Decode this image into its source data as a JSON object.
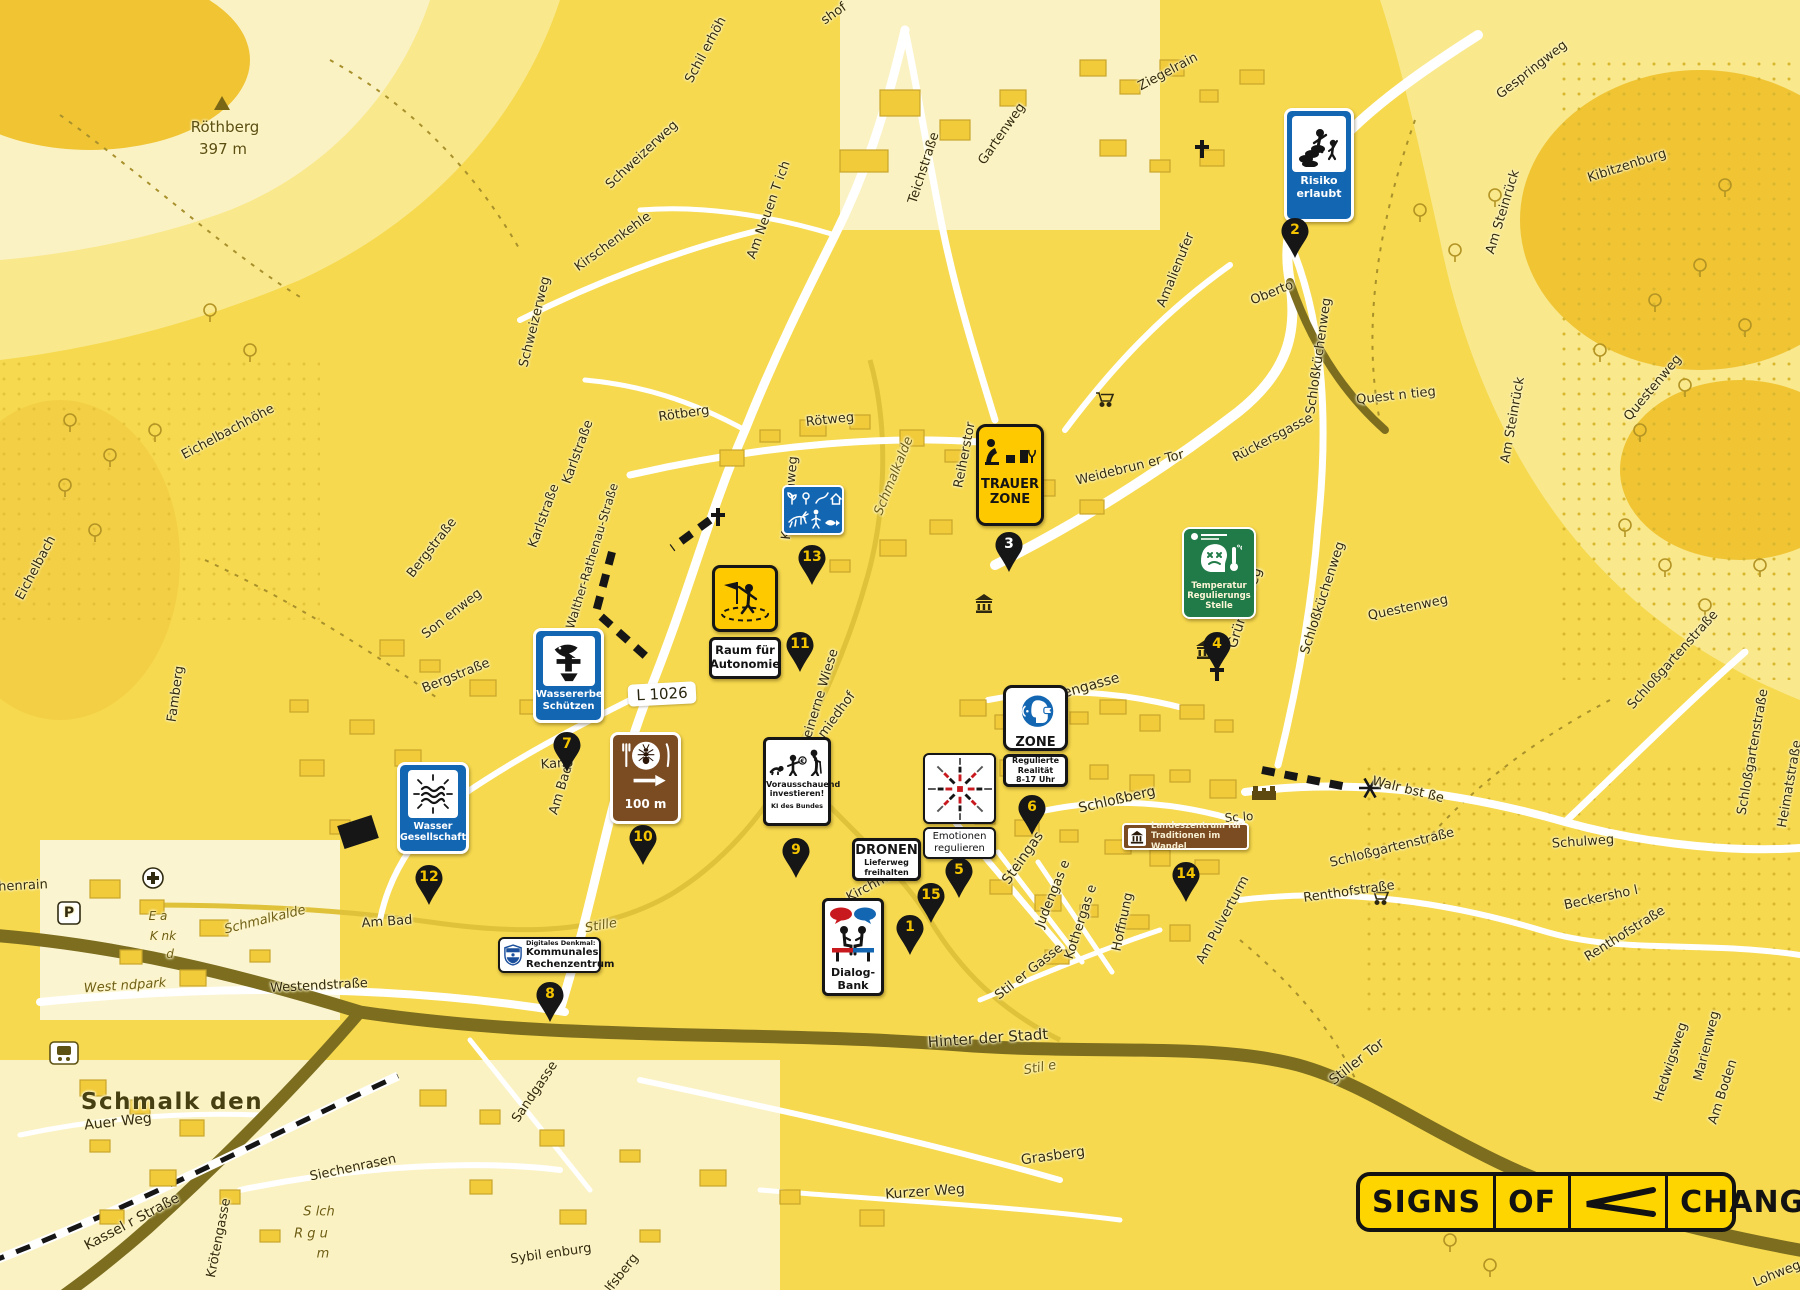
{
  "town": {
    "name": "Schmalk den"
  },
  "peak": {
    "name": "Röthberg",
    "elevation": "397 m"
  },
  "road_badge": "L 1026",
  "parking_label": "P",
  "logo": {
    "word1": "SIGNS",
    "word2": "OF",
    "word3": "CHANGE",
    "arrow_icon": "left-chevron-arrow",
    "bg_color": "#FFD500",
    "fg_color": "#121212"
  },
  "colors": {
    "map_base": "#F6D94E",
    "map_pale": "#FBF2C4",
    "road_white": "#FFFFFF",
    "road_major": "#7C6D1F",
    "sign_blue": "#1366B2",
    "sign_green": "#207B48",
    "sign_brown": "#7B4B22",
    "sign_yellow": "#FFC900",
    "pin_black": "#161616",
    "pin_number_yellow": "#F5C400",
    "accent_red": "#C8191E"
  },
  "icons": {
    "church": "cross-icon",
    "museum": "classical-building-icon",
    "peak": "triangle-icon",
    "hospital": "circle-plus-icon",
    "station": "train-icon",
    "cart": "shopping-cart-icon",
    "windmill": "asterisk-star-icon",
    "castle": "castle-icon"
  },
  "signs": {
    "risiko": {
      "line1": "Risiko",
      "line2": "erlaubt",
      "icon": "children-playing-on-rubble-icon"
    },
    "trauer": {
      "line1": "TRAUER",
      "line2": "ZONE",
      "icon": "mourning-person-tree-stumps-icon"
    },
    "temperatur": {
      "line1": "Temperatur",
      "line2": "Regulierungs",
      "line3": "Stelle",
      "unit": "C",
      "icon": "angry-head-thermometer-icon"
    },
    "wildlife": {
      "icon": "nature-pictogram-grid-icon"
    },
    "wassererbe": {
      "line1": "Wassererbe",
      "line2": "Schützen",
      "icon": "fish-totem-icon"
    },
    "raum": {
      "line1": "Raum für",
      "line2": "Autonomie",
      "icon": "figure-with-flag-icon"
    },
    "gasthaus": {
      "distance": "100 m",
      "icon": "insect-on-plate-fork-knife-icon",
      "arrow": "right-arrow-icon"
    },
    "vorausschauend": {
      "line1": "Vorausschauend",
      "line2": "investieren!",
      "sub": "KI des Bundes",
      "coin": "€",
      "icon": "baby-child-elder-icon"
    },
    "emotionen": {
      "line1": "Emotionen",
      "line2": "regulieren",
      "icon": "radial-emotion-diagram-icon"
    },
    "zone": {
      "title": "ZONE",
      "sub1": "Regulierte",
      "sub2": "Realität",
      "sub3": "8-17 Uhr",
      "icon": "vr-head-signal-icon"
    },
    "dronen": {
      "title": "DRONEN",
      "sub1": "Lieferweg",
      "sub2": "freihalten"
    },
    "dialog": {
      "line1": "Dialog-",
      "line2": "Bank",
      "icon": "two-figures-bench-speech-bubbles-icon"
    },
    "wasser": {
      "line1": "Wasser",
      "line2": "Gesellschaft",
      "icon": "radiant-waves-icon"
    },
    "rechenzentrum": {
      "kicker": "Digitales Denkmal:",
      "line1": "Kommunales",
      "line2": "Rechenzentrum",
      "icon": "heritage-shield-icon"
    },
    "landeszentrum": {
      "line1": "Landeszentrum für",
      "line2": "Traditionen im Wandel",
      "icon": "temple-icon"
    }
  },
  "markers": [
    {
      "n": "1",
      "color": "#F5C400"
    },
    {
      "n": "2",
      "color": "#F5C400"
    },
    {
      "n": "3",
      "color": "#FFFFFF"
    },
    {
      "n": "4",
      "color": "#F5C400"
    },
    {
      "n": "5",
      "color": "#F5C400"
    },
    {
      "n": "6",
      "color": "#F5C400"
    },
    {
      "n": "7",
      "color": "#F5C400"
    },
    {
      "n": "8",
      "color": "#F5C400"
    },
    {
      "n": "9",
      "color": "#F5C400"
    },
    {
      "n": "10",
      "color": "#F5C400"
    },
    {
      "n": "11",
      "color": "#F5C400"
    },
    {
      "n": "12",
      "color": "#F5C400"
    },
    {
      "n": "13",
      "color": "#F5C400"
    },
    {
      "n": "14",
      "color": "#F5C400"
    },
    {
      "n": "15",
      "color": "#F5C400"
    }
  ],
  "streets": [
    {
      "label": "Schil erhöh"
    },
    {
      "label": "shof"
    },
    {
      "label": "Schweizerweg"
    },
    {
      "label": "Kirschenkehle"
    },
    {
      "label": "Am Neuen T ich"
    },
    {
      "label": "Schweizerweg"
    },
    {
      "label": "Teichstraße"
    },
    {
      "label": "Gartenweg"
    },
    {
      "label": "Ziegelrain"
    },
    {
      "label": "Gespringweg"
    },
    {
      "label": "Kibitzenburg"
    },
    {
      "label": "Am Steinrück"
    },
    {
      "label": "Am Steinrück"
    },
    {
      "label": "Questenweg"
    },
    {
      "label": "Questenweg"
    },
    {
      "label": "Amalienufer"
    },
    {
      "label": "Oberto"
    },
    {
      "label": "Rückersgasse"
    },
    {
      "label": "Schloßküchenweg"
    },
    {
      "label": "Schloßküchenweg"
    },
    {
      "label": "Quest n tieg"
    },
    {
      "label": "Eichelbachhöhe"
    },
    {
      "label": "Eichelbach"
    },
    {
      "label": "Bergstraße"
    },
    {
      "label": "Bergstraße"
    },
    {
      "label": "Son enweg"
    },
    {
      "label": "Karlstraße"
    },
    {
      "label": "Karlstraße"
    },
    {
      "label": "Walther-Rathenau-Straße"
    },
    {
      "label": "Famberg"
    },
    {
      "label": "Kanonenweg"
    },
    {
      "label": "Rötberg"
    },
    {
      "label": "Rötweg"
    },
    {
      "label": "Schmalkalde"
    },
    {
      "label": "Reiherstor"
    },
    {
      "label": "Weidebrun er Tor"
    },
    {
      "label": "Pfaffengasse"
    },
    {
      "label": "Grüner Weg"
    },
    {
      "label": "Schloßberg"
    },
    {
      "label": "Steingas"
    },
    {
      "label": "Judengas e"
    },
    {
      "label": "Kothergas e"
    },
    {
      "label": "Stil er Gasse"
    },
    {
      "label": "Hoffnung"
    },
    {
      "label": "Am Pulverturm"
    },
    {
      "label": "Renthofstraße"
    },
    {
      "label": "Renthofstraße"
    },
    {
      "label": "Beckersho l"
    },
    {
      "label": "Schulweg"
    },
    {
      "label": "Walr bst ße"
    },
    {
      "label": "Schloßgartenstraße"
    },
    {
      "label": "Schloßgartenstraße"
    },
    {
      "label": "Schloßgartenstraße"
    },
    {
      "label": "Heimatstraße"
    },
    {
      "label": "Marienweg"
    },
    {
      "label": "Hedwigsweg"
    },
    {
      "label": "Am Boden"
    },
    {
      "label": "Stiller Tor"
    },
    {
      "label": "Stil e"
    },
    {
      "label": "Hinter der Stadt"
    },
    {
      "label": "Grasberg"
    },
    {
      "label": "Kurzer Weg"
    },
    {
      "label": "Sandgasse"
    },
    {
      "label": "Siechenrasen"
    },
    {
      "label": "Auer Weg"
    },
    {
      "label": "Kassel r Straße"
    },
    {
      "label": "Krötengasse"
    },
    {
      "label": "Schmalk den"
    },
    {
      "label": "Sybil enburg"
    },
    {
      "label": "Wolfsberg"
    },
    {
      "label": "Westendstraße"
    },
    {
      "label": "West ndpark"
    },
    {
      "label": "Schmalkalde"
    },
    {
      "label": "Stille"
    },
    {
      "label": "henrain"
    },
    {
      "label": "E a"
    },
    {
      "label": "K nk"
    },
    {
      "label": "d"
    },
    {
      "label": "S lch"
    },
    {
      "label": "R g u"
    },
    {
      "label": "m"
    },
    {
      "label": "Am Bad"
    },
    {
      "label": "Am Bad"
    },
    {
      "label": "Kano"
    },
    {
      "label": "Steinerne Wiese"
    },
    {
      "label": "miedhof"
    },
    {
      "label": "Kirchhof"
    },
    {
      "label": "Sc lo"
    },
    {
      "label": "Lohweg"
    },
    {
      "label": "Röthberg"
    },
    {
      "label": "397 m"
    }
  ]
}
